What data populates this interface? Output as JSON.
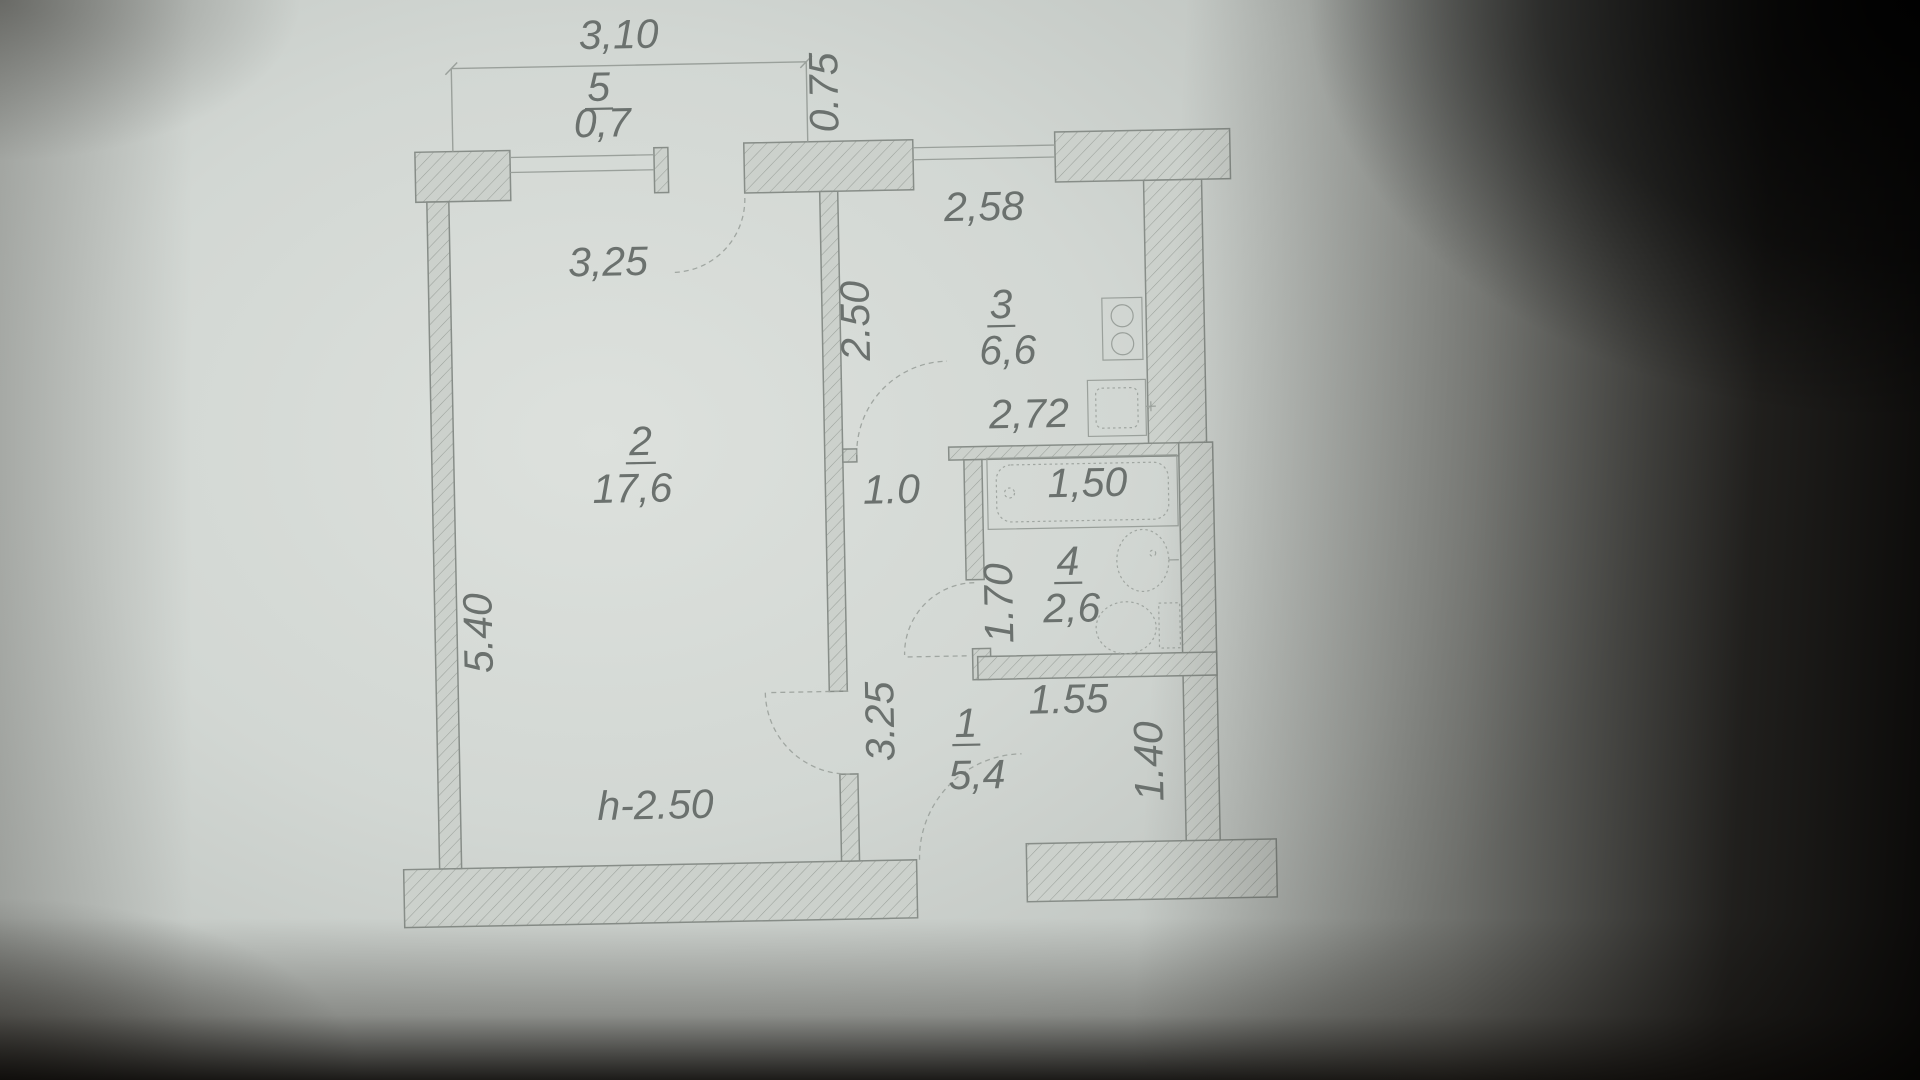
{
  "plan": {
    "rooms": {
      "r5": {
        "number": "5",
        "area": "0,7"
      },
      "r2": {
        "number": "2",
        "area": "17,6"
      },
      "r3": {
        "number": "3",
        "area": "6,6"
      },
      "r4": {
        "number": "4",
        "area": "2,6"
      },
      "r1": {
        "number": "1",
        "area": "5,4"
      }
    },
    "dims": {
      "balcony_width": "3,10",
      "balcony_depth": "0.75",
      "room2_width": "3,25",
      "room2_length": "5.40",
      "ceiling_height": "h-2.50",
      "kitchen_width": "2,58",
      "kitchen_length": "2.50",
      "kitchen_width_bottom": "2,72",
      "passage_width": "1.0",
      "bathroom_width": "1,50",
      "bathroom_length": "1.70",
      "hallway_niche_width": "1.55",
      "hallway_length": "3.25",
      "hallway_width": "1.40"
    },
    "colors": {
      "paper": "#d4d9d5",
      "ink": "#878d88",
      "text": "#6b716e",
      "shadow": "#0a0908"
    }
  }
}
